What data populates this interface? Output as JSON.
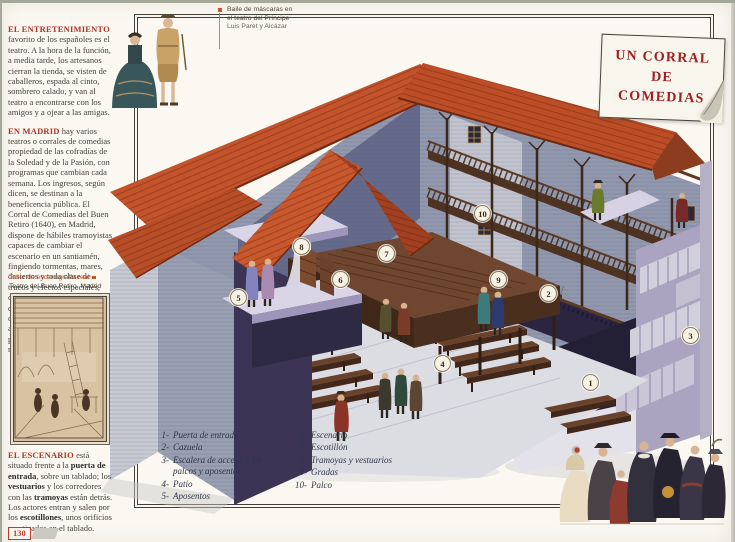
{
  "page": {
    "number": "130"
  },
  "title_box": {
    "line1": "UN CORRAL",
    "line2": "DE",
    "line3": "COMEDIAS"
  },
  "top_caption": {
    "line1": "Baile de máscaras en",
    "line2": "el teatro del Príncipe",
    "line3": "Luis Paret y Alcázar"
  },
  "left_column": {
    "para1_lead": "EL ENTRETENIMIENTO",
    "para1_text": " favorito de los españoles es el teatro. A la hora de la función, a media tarde, los artesanos cierran la tienda, se visten de caballeros, espada al cinto, sombrero calado, y van al teatro a encontrarse con los amigos y a ojear a las amigas.",
    "para2_lead": "EN MADRID",
    "para2_text": " hay varios teatros o corrales de comedias propiedad de las cofradías de la Soledad y de la Pasión, con programas que cambian cada semana. Los ingresos, según dicen, se destinan a la beneficencia pública. El Corral de Comedias del Buen Retiro (1640), en Madrid, dispone de hábiles tramoyistas capaces de cambiar el escenario en un santiamén, fingiendo tormentas, mares, desiertos y toda clase de trucos y efectos especiales, cuya importancia, en el conjunto del espectáculo, crece de día en día: ascensos al cielo, rocas que se abren, paisajes en perspectiva, ríos, mares, fieras...",
    "engraving_caption1": "Taller de escenografía real",
    "engraving_caption2": "Teatro del Buen Retiro, Madrid",
    "para3_lead": "EL ESCENARIO",
    "para3_segments": [
      {
        "text": " está situado frente a la ",
        "bold": false
      },
      {
        "text": "puerta de entrada",
        "bold": true
      },
      {
        "text": ", sobre un tablado; los ",
        "bold": false
      },
      {
        "text": "vestuarios",
        "bold": true
      },
      {
        "text": " y los corredores con las ",
        "bold": false
      },
      {
        "text": "tramoyas",
        "bold": true
      },
      {
        "text": " están detrás. Los actores entran y salen por los ",
        "bold": false
      },
      {
        "text": "escotillones",
        "bold": true
      },
      {
        "text": ", unos orificios practicados en el tablado.",
        "bold": false
      }
    ]
  },
  "legend": {
    "col1": [
      {
        "num": "1-",
        "label": "Puerta de entrada"
      },
      {
        "num": "2-",
        "label": "Cazuela"
      },
      {
        "num": "3-",
        "label": "Escalera de acceso a los palcos y aposentos"
      },
      {
        "num": "4-",
        "label": "Patio"
      },
      {
        "num": "5-",
        "label": "Aposentos"
      }
    ],
    "col2": [
      {
        "num": "6-",
        "label": "Escenario"
      },
      {
        "num": "7-",
        "label": "Escotillón"
      },
      {
        "num": "8-",
        "label": "Tramoyas y vestuarios"
      },
      {
        "num": "9-",
        "label": "Gradas"
      },
      {
        "num": "10-",
        "label": "Palco"
      }
    ]
  },
  "markers": [
    {
      "num": "1",
      "x": 590,
      "y": 382
    },
    {
      "num": "2",
      "x": 548,
      "y": 293
    },
    {
      "num": "3",
      "x": 690,
      "y": 335
    },
    {
      "num": "4",
      "x": 442,
      "y": 363
    },
    {
      "num": "5",
      "x": 238,
      "y": 297
    },
    {
      "num": "6",
      "x": 340,
      "y": 279
    },
    {
      "num": "7",
      "x": 386,
      "y": 253
    },
    {
      "num": "8",
      "x": 301,
      "y": 246
    },
    {
      "num": "9",
      "x": 498,
      "y": 279
    },
    {
      "num": "10",
      "x": 482,
      "y": 213
    }
  ],
  "colors": {
    "accent_red": "#9e1f23",
    "roof": "#c1512a",
    "wood": "#5a3826",
    "wall": "#98a0b4"
  }
}
